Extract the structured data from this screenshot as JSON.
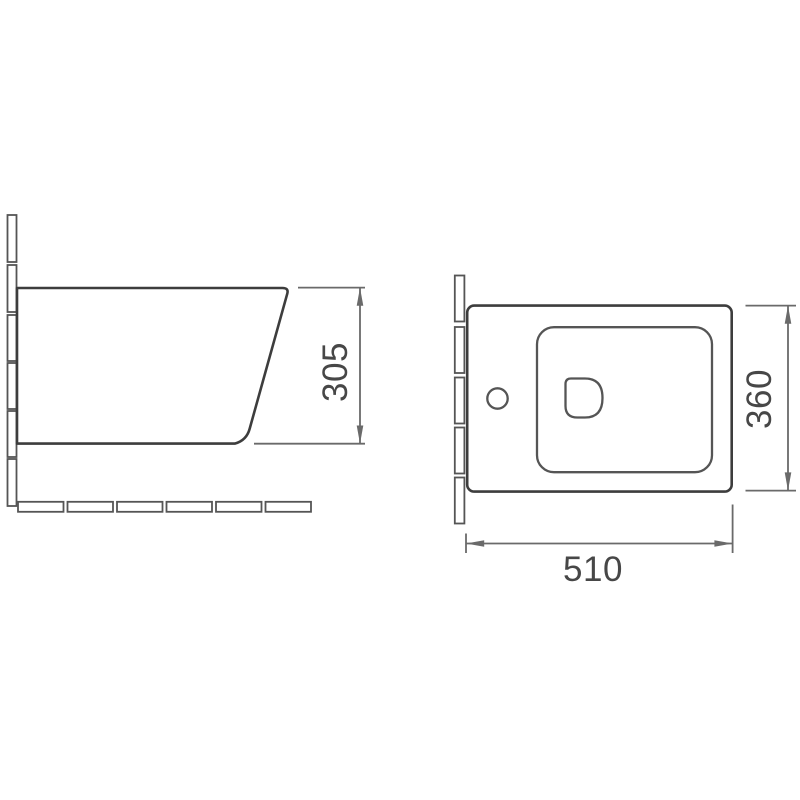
{
  "colors": {
    "background": "#ffffff",
    "object_line": "#3d3d3d",
    "detail_line": "#555555",
    "dimension_line": "#6a6a6a",
    "text": "#474747"
  },
  "views": {
    "side_elevation": {
      "dimensions": {
        "height": "305"
      }
    },
    "plan": {
      "dimensions": {
        "depth": "360",
        "width": "510"
      }
    }
  }
}
